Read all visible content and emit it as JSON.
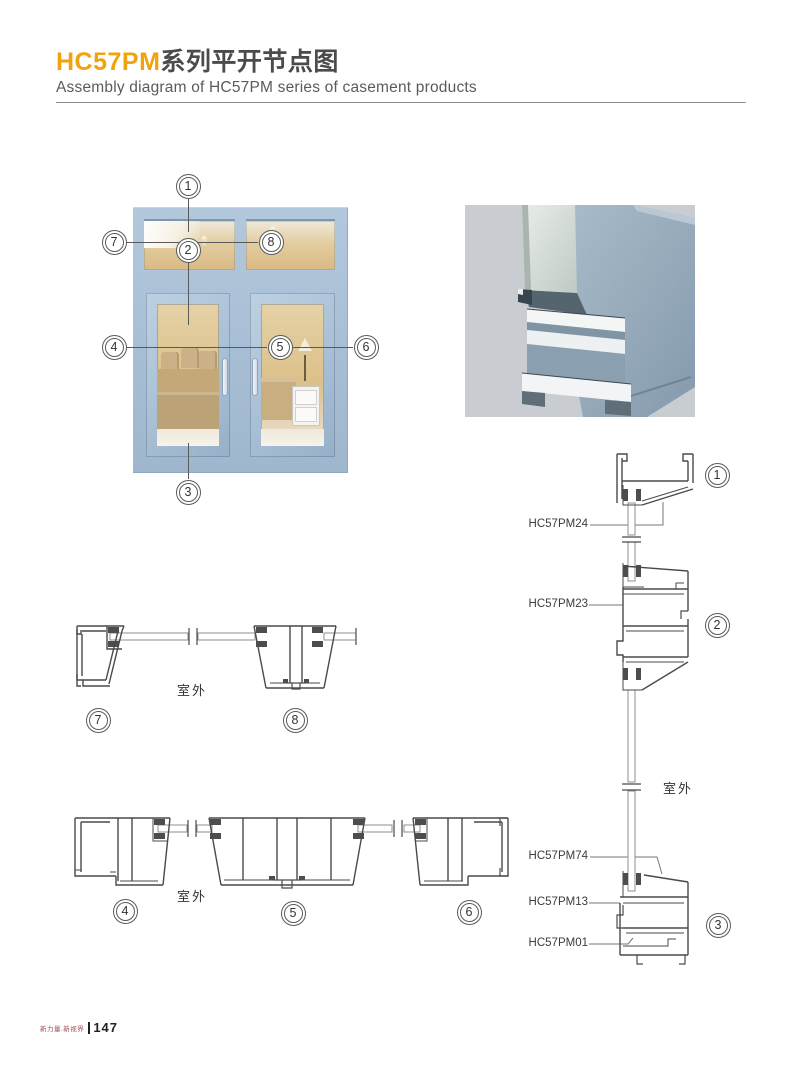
{
  "header": {
    "title_code": "HC57PM",
    "title_zh": "系列平开节点图",
    "subtitle": "Assembly diagram of HC57PM series of casement products"
  },
  "callouts": {
    "c1": "1",
    "c2": "2",
    "c3": "3",
    "c4": "4",
    "c5": "5",
    "c6": "6",
    "c7": "7",
    "c8": "8"
  },
  "labels": {
    "outdoor": "室外",
    "pm24": "HC57PM24",
    "pm23": "HC57PM23",
    "pm74": "HC57PM74",
    "pm13": "HC57PM13",
    "pm01": "HC57PM01"
  },
  "footer": {
    "slogan": "新力量.新视界",
    "page_number": "147"
  },
  "colors": {
    "accent": "#F2A20C",
    "frame_blue": "#A9C0D7",
    "drawing_line": "#4A4A4A"
  }
}
